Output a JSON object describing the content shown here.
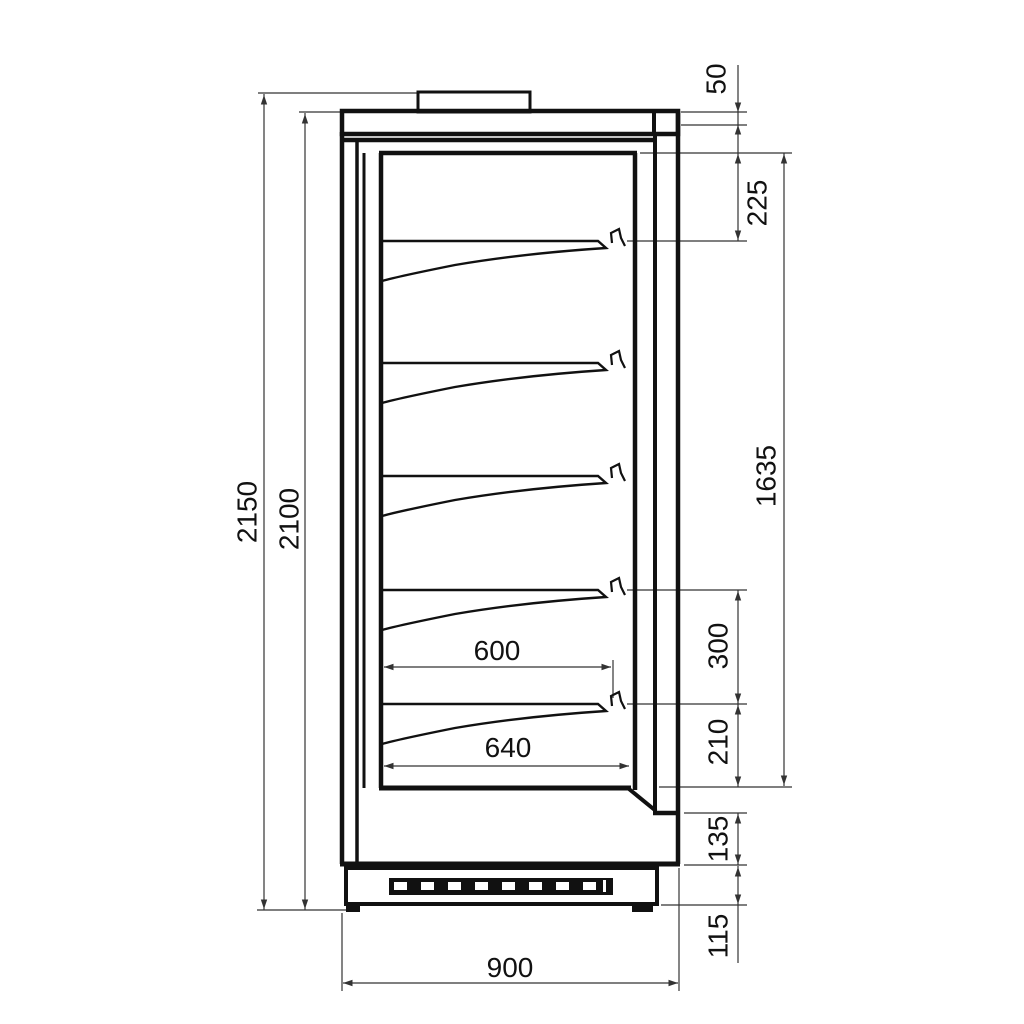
{
  "drawing": {
    "kind": "side-section technical drawing of display cabinet",
    "shelf_count": 5,
    "line_color": "#111111",
    "dimension_line_color": "#333333",
    "background_color": "#ffffff",
    "dims": {
      "overall_height": "2150",
      "body_height": "2100",
      "canopy_height": "50",
      "top_to_first_shelf": "225",
      "interior_height": "1635",
      "shelf_spacing": "300",
      "bottom_shelf_clearance": "210",
      "front_lower_panel": "135",
      "plinth_height": "115",
      "shelf_depth": "600",
      "well_depth": "640",
      "overall_depth": "900"
    }
  }
}
